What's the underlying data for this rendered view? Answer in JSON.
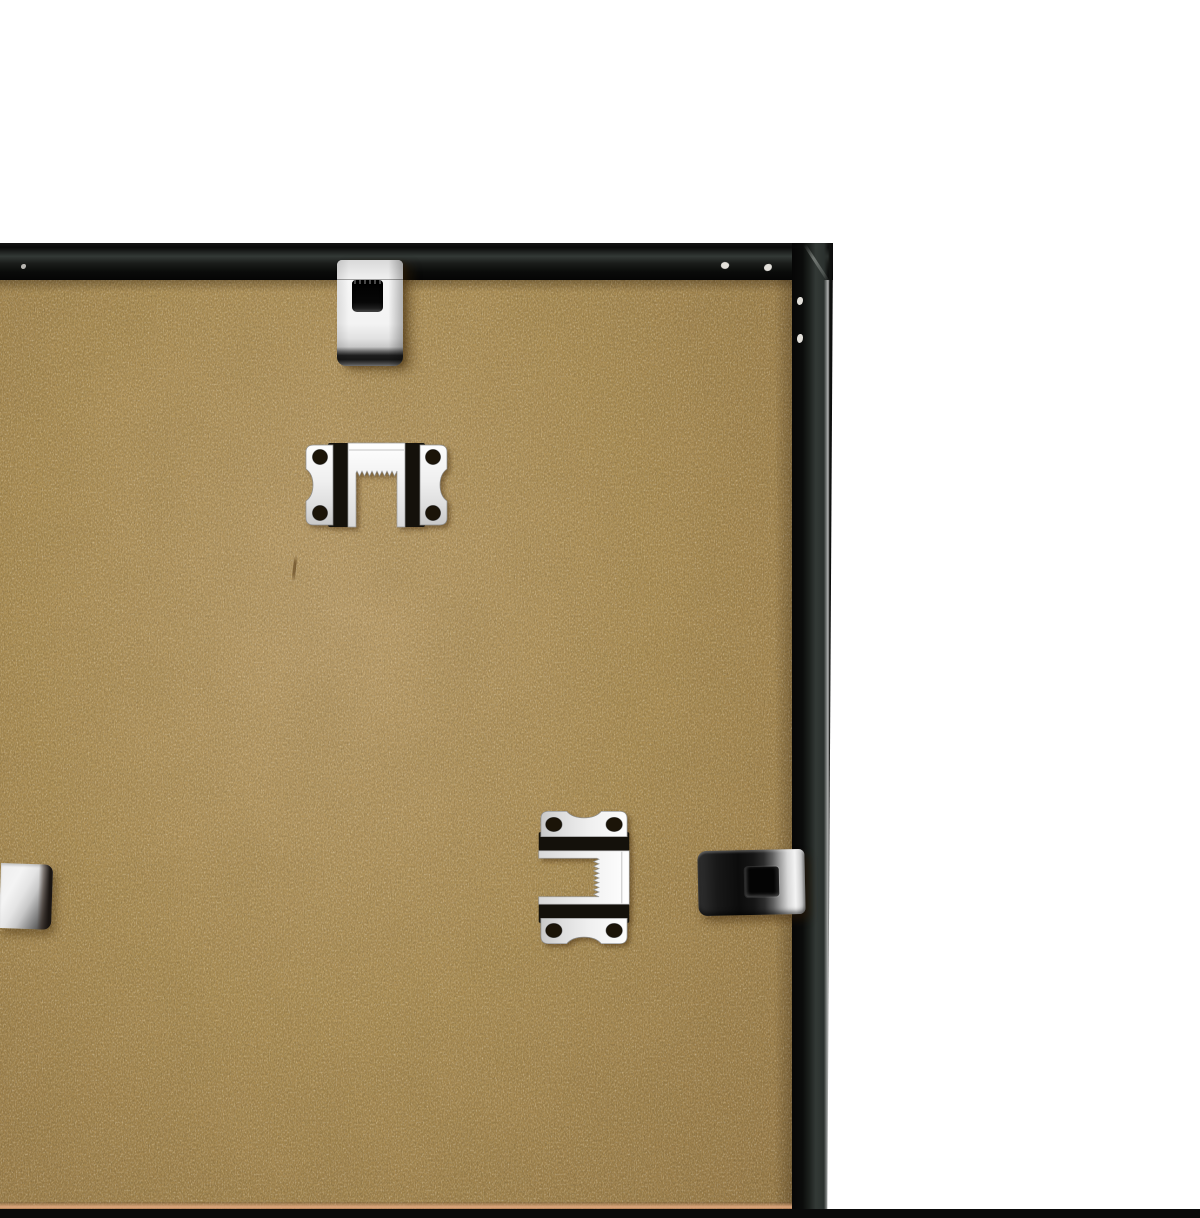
{
  "image_type": "product-photo",
  "subject": "Back of a black picture frame showing an MDF backing board with metal spring clips and sawtooth hanger plates on a white background",
  "colors": {
    "white_bg": "#ffffff",
    "mdf_base": "#b29459",
    "mdf_light": "#c2a46f",
    "mdf_dark": "#9d7f4b",
    "frame_black": "#0a0b0a",
    "frame_graphite": "#333936",
    "metal_bright": "#f4f4f4",
    "metal_mid": "#c8c8c8",
    "metal_dark": "#1d1d1d",
    "bottom_strip": "#0a0a0a",
    "mdf_edge_line": "#e0a87e"
  },
  "objects": [
    {
      "name": "mdf-backing-board",
      "label": "MDF backing board",
      "x": 0,
      "y": 262,
      "w": 794,
      "h": 929
    },
    {
      "name": "frame-top-edge",
      "label": "black frame top rail",
      "x": 0,
      "y": 225,
      "w": 833,
      "h": 37
    },
    {
      "name": "frame-right-edge",
      "label": "black frame right rail",
      "x": 792,
      "y": 225,
      "w": 41,
      "h": 975
    },
    {
      "name": "bottom-frame-strip",
      "label": "black strip at bottom crop",
      "x": 0,
      "y": 1191,
      "w": 1200,
      "h": 9
    },
    {
      "name": "spring-clip-top",
      "label": "metal spring clip on top rail",
      "x": 337,
      "y": 242,
      "w": 66,
      "h": 106
    },
    {
      "name": "sawtooth-hanger-top",
      "label": "sawtooth hanger plate, horizontal, notch facing down",
      "x": 303,
      "y": 422,
      "w": 147,
      "h": 90
    },
    {
      "name": "sawtooth-hanger-side",
      "label": "sawtooth hanger plate, vertical, notch facing left",
      "x": 535,
      "y": 790,
      "w": 97,
      "h": 138
    },
    {
      "name": "spring-clip-right",
      "label": "metal spring clip on right rail",
      "x": 698,
      "y": 832,
      "w": 107,
      "h": 65
    },
    {
      "name": "spring-clip-left",
      "label": "partially visible metal clip at left crop edge",
      "x": 0,
      "y": 845,
      "w": 52,
      "h": 65
    }
  ]
}
